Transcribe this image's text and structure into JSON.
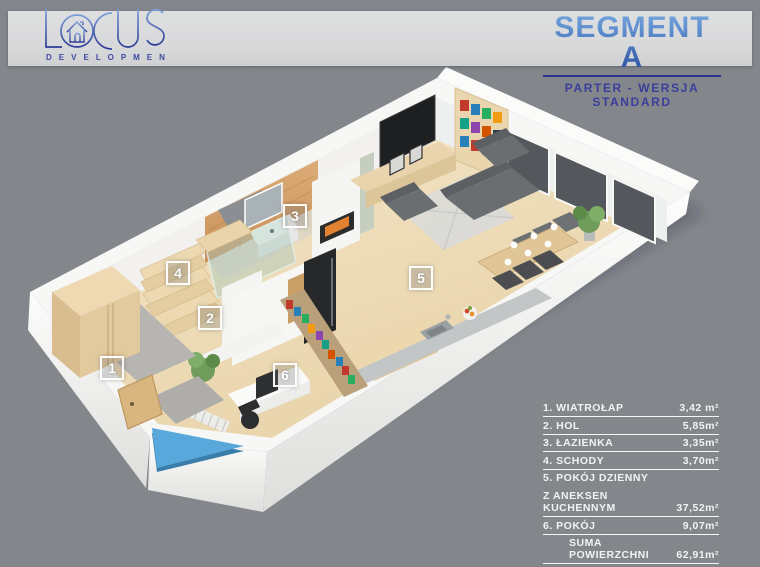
{
  "page": {
    "background": "#83878c",
    "band_color": "#d8d9da"
  },
  "logo": {
    "letter_l": "L",
    "letters_cus": "CUS",
    "subtitle": "D E V E L O P M E N T",
    "accent_light": "#7d9fd8",
    "accent_dark": "#2f3d99"
  },
  "header": {
    "title": "SEGMENT A",
    "subtitle": "PARTER - WERSJA STANDARD",
    "underline_color": "#2b3191"
  },
  "floorplan": {
    "entrance_arrow_color": "#58a8dc",
    "rooms": [
      {
        "number": "1"
      },
      {
        "number": "2"
      },
      {
        "number": "3"
      },
      {
        "number": "4"
      },
      {
        "number": "5"
      },
      {
        "number": "6"
      }
    ]
  },
  "legend": {
    "rows": [
      {
        "label": "1. WIATROŁAP",
        "value": "3,42 m²"
      },
      {
        "label": "2. HOL",
        "value": "5,85m²"
      },
      {
        "label": "3. ŁAZIENKA",
        "value": "3,35m²"
      },
      {
        "label": "4. SCHODY",
        "value": "3,70m²"
      },
      {
        "label": "5. POKÓJ DZIENNY",
        "value": ""
      },
      {
        "label": "Z ANEKSEN KUCHENNYM",
        "value": "37,52m²"
      },
      {
        "label": "6. POKÓJ",
        "value": "9,07m²"
      },
      {
        "label": "SUMA POWIERZCHNI",
        "value": "62,91m²"
      }
    ]
  }
}
